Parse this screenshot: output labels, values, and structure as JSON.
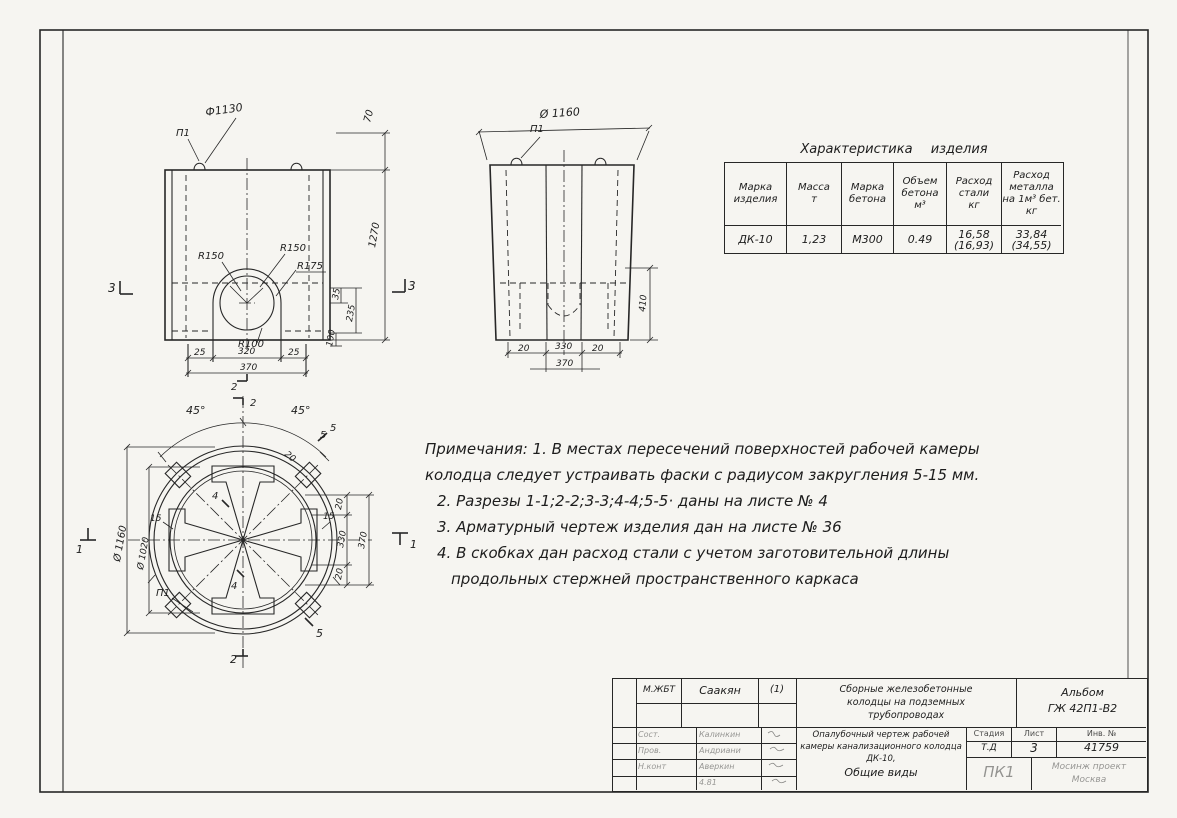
{
  "views": {
    "front": {
      "dia": "Ф1130",
      "loop": "П1",
      "d70": "70",
      "d1270": "1270",
      "r150a": "R150",
      "r150b": "R150",
      "r175": "R175",
      "r100": "R100",
      "d25a": "25",
      "d320": "320",
      "d25b": "25",
      "d370": "370",
      "d35": "35",
      "d235": "235",
      "d100": "100",
      "m3a": "3",
      "m3b": "3",
      "m2": "2"
    },
    "side": {
      "dia": "Ø 1160",
      "loop": "П1",
      "d20a": "20",
      "d330": "330",
      "d20b": "20",
      "d370": "370",
      "d410": "410"
    },
    "plan": {
      "a45l": "45°",
      "a45r": "45°",
      "d20diag": "20",
      "d5": "5",
      "m2t": "2",
      "m2b": "2",
      "m1l": "1",
      "m1r": "1",
      "m4a": "4",
      "m4b": "4",
      "m5a": "5",
      "m5b": "5",
      "dia_out": "Ø 1160",
      "dia_in": "Ø 1020",
      "d15l": "15",
      "d15r": "15",
      "d20t": "20",
      "d330": "330",
      "d20b": "20",
      "d370": "370",
      "loop": "П1"
    }
  },
  "char_table": {
    "title": "Характеристика изделия",
    "headers": [
      "Марка\nизделия",
      "Масса\nт",
      "Марка\nбетона",
      "Объем\nбетона\nм³",
      "Расход\nстали\nкг",
      "Расход\nметалла\nна 1м³ бет.\nкг"
    ],
    "row": [
      "ДК-10",
      "1,23",
      "М300",
      "0.49",
      "16,58\n(16,93)",
      "33,84\n(34,55)"
    ]
  },
  "notes": {
    "lines": [
      "Примечания: 1. В местах пересечений поверхностей рабочей камеры",
      "колодца следует устраивать фаски с радиусом закругления 5-15 мм.",
      "2. Разрезы 1-1;2-2;3-3;4-4;5-5·  даны   на листе № 4",
      "3. Арматурный чертеж изделия   дан   на листе № 36",
      "4. В скобках дан расход стали с учетом заготовительной длины",
      "продольных стержней пространственного каркаса"
    ]
  },
  "stamp": {
    "dept": "М.ЖБТ",
    "dept_name": "Саакян",
    "dept_sign": "(1)",
    "rows": [
      {
        "role": "Сост.",
        "name": "Калинкин"
      },
      {
        "role": "Пров.",
        "name": "Андриани"
      },
      {
        "role": "Н.конт",
        "name": "Аверкин"
      },
      {
        "role": "",
        "name": "4.81"
      }
    ],
    "project": [
      "Сборные железобетонные",
      "колодцы на подземных",
      "трубопроводах"
    ],
    "album": [
      "Альбом",
      "ГЖ 42П1-В2"
    ],
    "doc_title": [
      "Опалубочный чертеж рабочей",
      "камеры канализационного колодца",
      "ДК-10,",
      "Общие виды"
    ],
    "cols": {
      "stage_h": "Стадия",
      "sheet_h": "Лист",
      "inv_h": "Инв. №",
      "stage_v": "Т.Д",
      "sheet_v": "3",
      "inv_v": "41759"
    },
    "stamp_mark": "ПК1",
    "org": [
      "Мосинж проект",
      "Москва"
    ]
  }
}
